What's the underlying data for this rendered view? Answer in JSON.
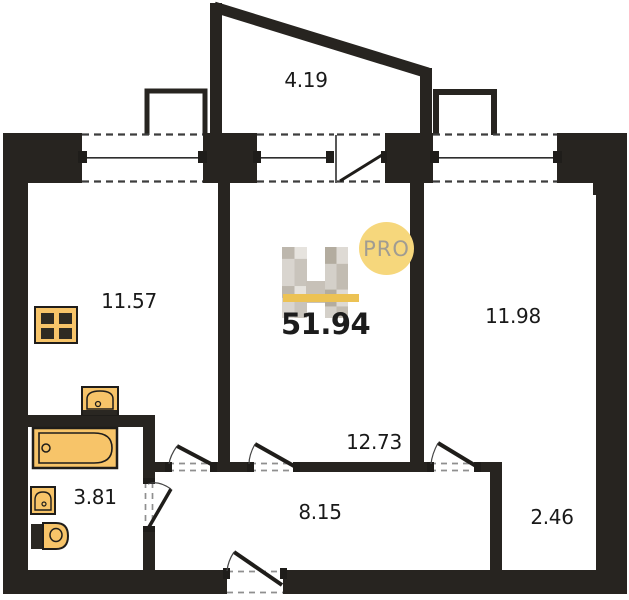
{
  "plan": {
    "watermark": {
      "total_area": "51.94",
      "pro_label": "PRO",
      "logo_icon": "faceted-h-logo-icon"
    },
    "rooms": [
      {
        "id": "balcony",
        "area": "4.19"
      },
      {
        "id": "kitchen",
        "area": "11.57"
      },
      {
        "id": "living-room",
        "area": "12.73"
      },
      {
        "id": "bedroom",
        "area": "11.98"
      },
      {
        "id": "hallway",
        "area": "8.15"
      },
      {
        "id": "bathroom",
        "area": "3.81"
      },
      {
        "id": "storage",
        "area": "2.46"
      }
    ],
    "fixtures": [
      "stove-icon",
      "kitchen-sink-icon",
      "bathtub-icon",
      "washbasin-icon",
      "toilet-icon"
    ],
    "colors": {
      "wall": "#272420",
      "fixture_fill": "#f7c469",
      "accent_bar": "#ecc254",
      "pro_badge_bg": "#f6d77c",
      "pro_badge_text": "#a09c92",
      "label_text": "#191919"
    }
  }
}
